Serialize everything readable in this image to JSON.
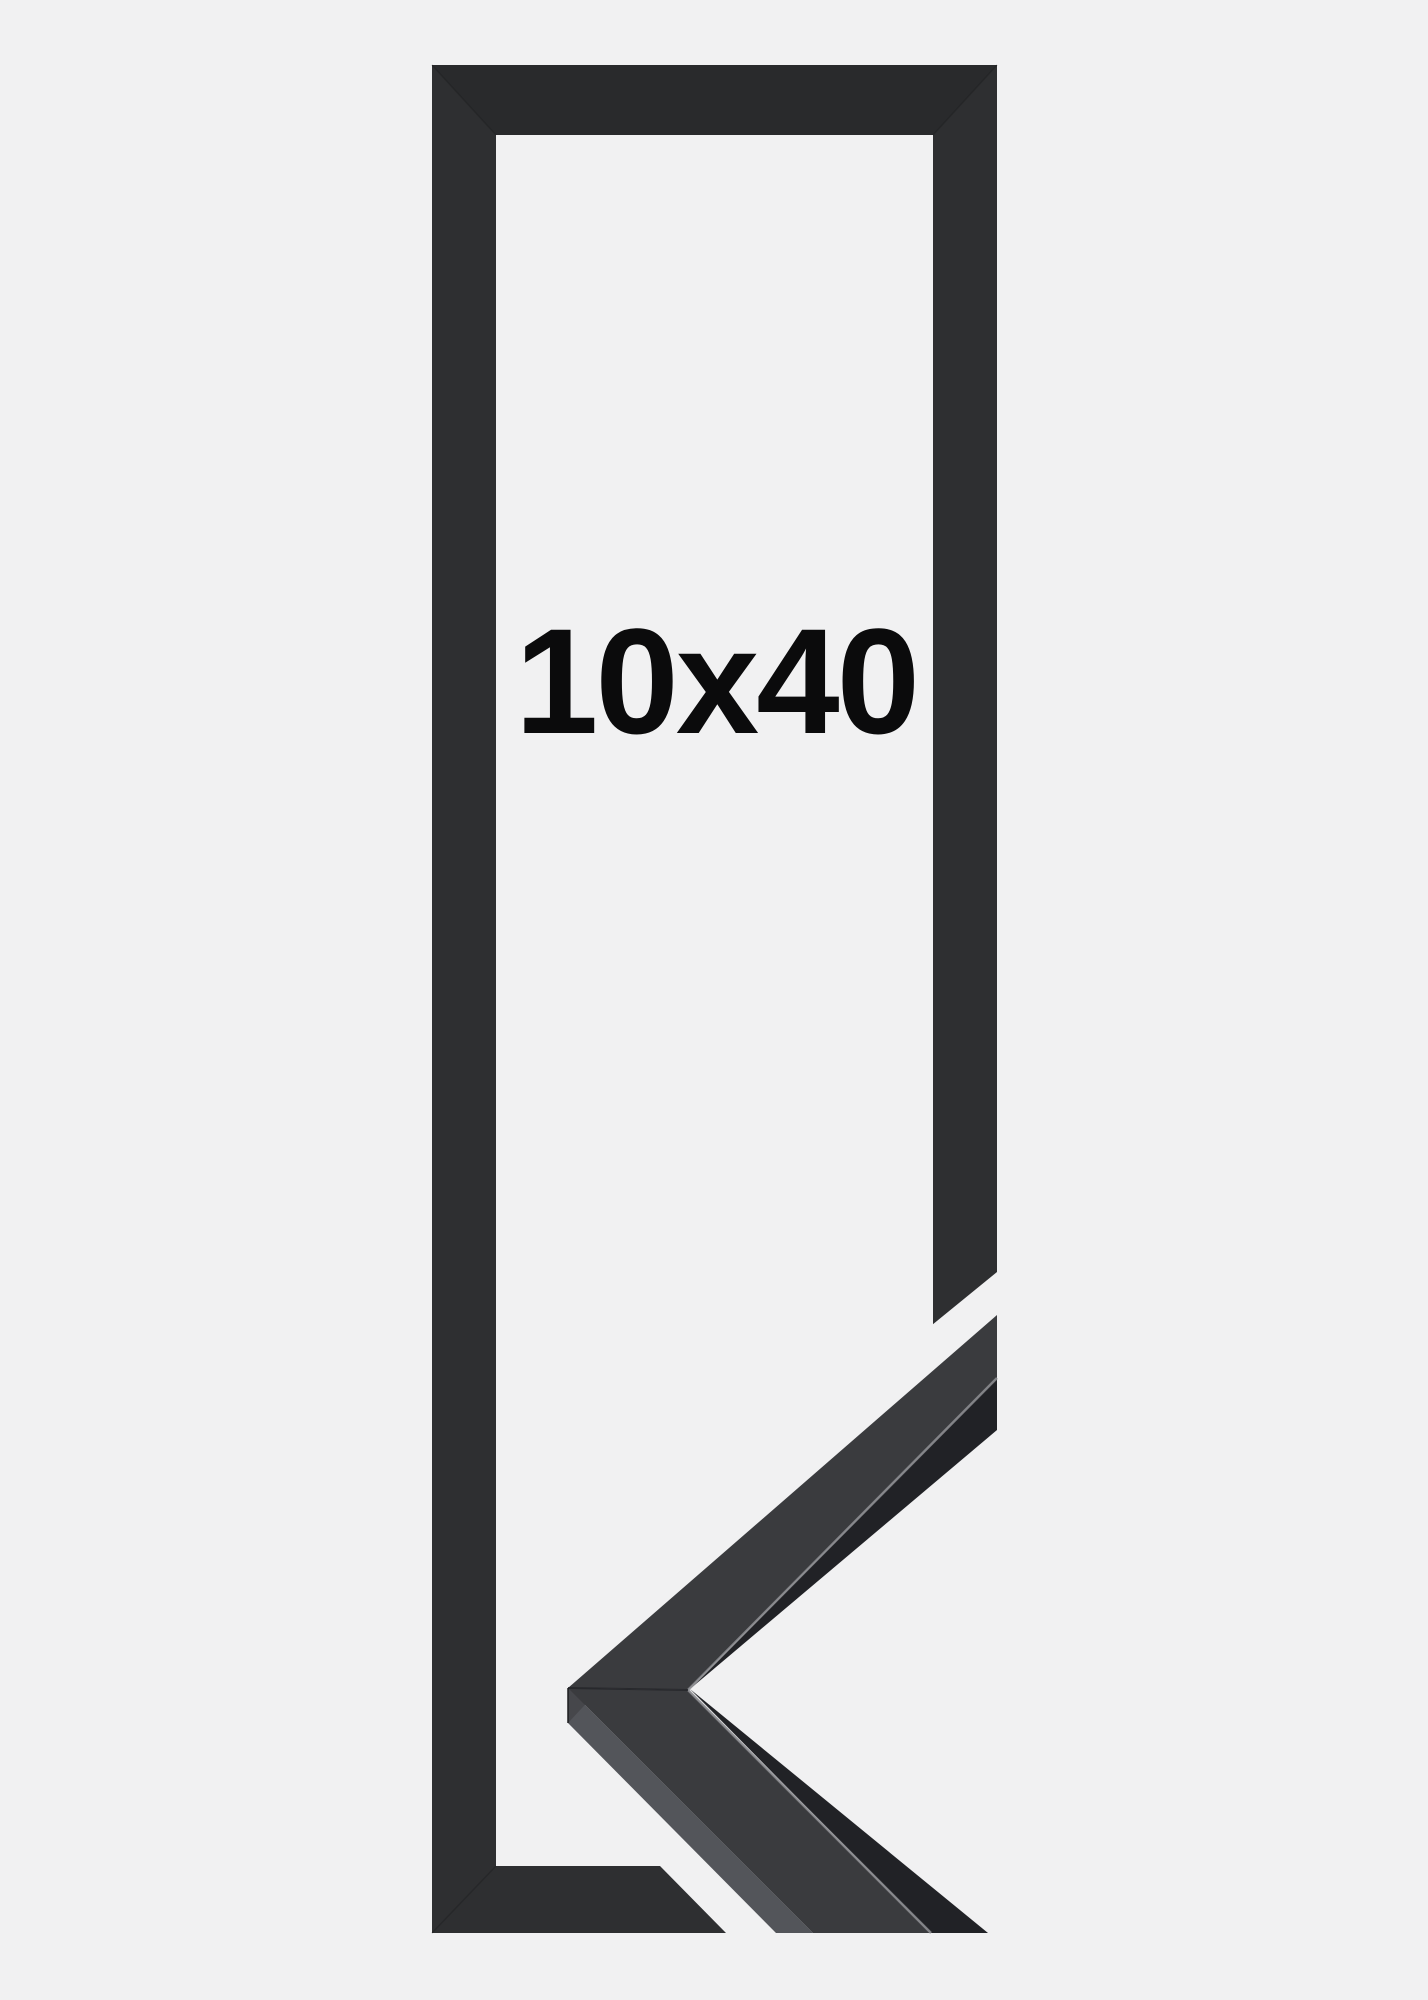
{
  "product": {
    "label": "10x40",
    "description": "black picture frame product photo with corner profile close-up"
  },
  "colors": {
    "background": "#f1f1f2",
    "frame": "#2e2f31",
    "sample_face": "#3a3b3e",
    "sample_side": "#46474b",
    "sample_side_light": "#53555a",
    "sample_lip": "#212226",
    "sample_highlight": "#8e8f93",
    "seam": "#1a1b1c",
    "text": "#0b0b0c"
  }
}
